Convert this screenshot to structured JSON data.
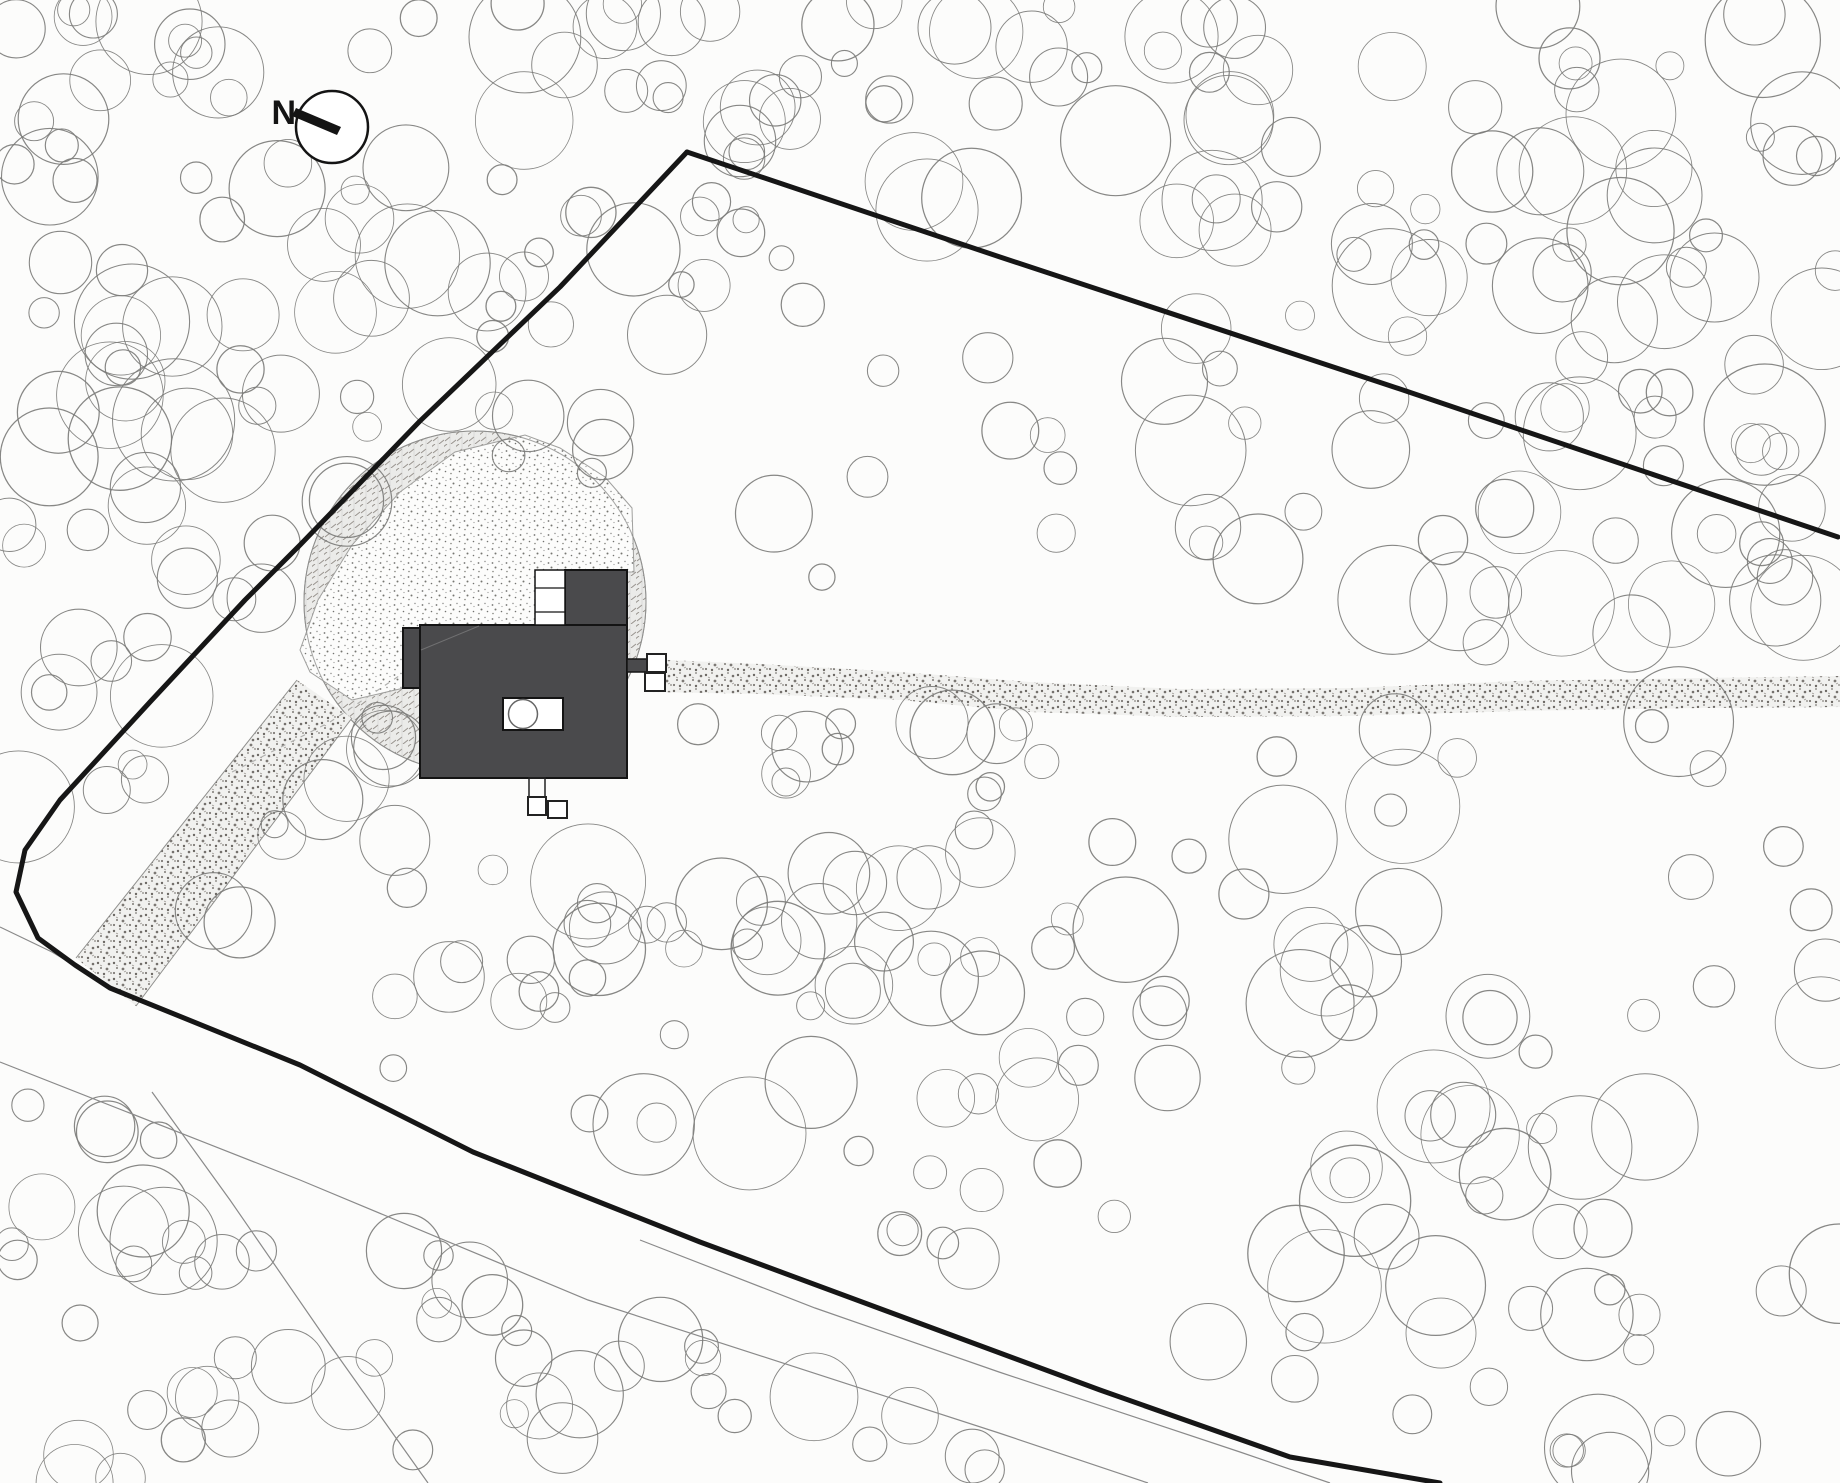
{
  "title": "Architectural site plan",
  "compass": {
    "label": "N",
    "cx": 332,
    "cy": 127,
    "r": 36,
    "needle": [
      [
        292,
        116
      ],
      [
        296,
        108
      ],
      [
        341,
        127
      ],
      [
        337,
        135
      ]
    ],
    "label_x": 296,
    "label_y": 124
  },
  "colors": {
    "background": "#fcfcfb",
    "boundary": "#161616",
    "thin_line": "#8a8a8a",
    "tree_stroke": "#7a7a78",
    "building_fill": "#4a4a4c",
    "building_outline": "#141414",
    "hatch_outline": "#8f8f8d",
    "stipple_edge": "#a0a09e",
    "contour_dash": "#b0b0ae",
    "white": "#ffffff"
  },
  "site": {
    "clearing": {
      "cx": 475,
      "cy": 602,
      "r": 171
    },
    "stipple_area": [
      [
        300,
        650
      ],
      [
        318,
        600
      ],
      [
        352,
        545
      ],
      [
        400,
        492
      ],
      [
        455,
        452
      ],
      [
        525,
        435
      ],
      [
        560,
        448
      ],
      [
        605,
        477
      ],
      [
        632,
        508
      ],
      [
        634,
        572
      ],
      [
        565,
        572
      ],
      [
        565,
        625
      ],
      [
        420,
        627
      ],
      [
        404,
        688
      ],
      [
        352,
        700
      ],
      [
        310,
        672
      ]
    ],
    "corridor": {
      "poly": [
        [
          297,
          680
        ],
        [
          352,
          718
        ],
        [
          136,
          1006
        ],
        [
          76,
          958
        ]
      ],
      "edge1": [
        [
          297,
          680
        ],
        [
          76,
          958
        ]
      ],
      "edge2": [
        [
          352,
          718
        ],
        [
          136,
          1006
        ]
      ]
    },
    "access_path": [
      [
        642,
        659
      ],
      [
        760,
        664
      ],
      [
        900,
        672
      ],
      [
        1030,
        682
      ],
      [
        1180,
        689
      ],
      [
        1350,
        688
      ],
      [
        1520,
        681
      ],
      [
        1700,
        678
      ],
      [
        1840,
        676
      ],
      [
        1840,
        707
      ],
      [
        1700,
        708
      ],
      [
        1520,
        711
      ],
      [
        1350,
        716
      ],
      [
        1180,
        717
      ],
      [
        1030,
        712
      ],
      [
        900,
        700
      ],
      [
        760,
        694
      ],
      [
        652,
        692
      ]
    ],
    "contour_dashed": [
      [
        232,
        772
      ],
      [
        330,
        722
      ],
      [
        420,
        662
      ]
    ],
    "boundary_left_bottom": [
      [
        687,
        152
      ],
      [
        560,
        287
      ],
      [
        420,
        421
      ],
      [
        300,
        545
      ],
      [
        245,
        600
      ],
      [
        150,
        702
      ],
      [
        60,
        800
      ],
      [
        25,
        850
      ],
      [
        16,
        892
      ],
      [
        38,
        938
      ],
      [
        75,
        965
      ],
      [
        110,
        988
      ],
      [
        300,
        1065
      ],
      [
        473,
        1152
      ],
      [
        700,
        1242
      ],
      [
        954,
        1336
      ],
      [
        1100,
        1390
      ],
      [
        1290,
        1457
      ],
      [
        1440,
        1483
      ]
    ],
    "boundary_top_right": [
      [
        687,
        152
      ],
      [
        1000,
        257
      ],
      [
        1400,
        389
      ],
      [
        1838,
        537
      ]
    ],
    "roads": [
      {
        "pts": [
          [
            0,
            927
          ],
          [
            52,
            952
          ],
          [
            92,
            976
          ]
        ]
      },
      {
        "pts": [
          [
            0,
            1062
          ],
          [
            300,
            1180
          ],
          [
            588,
            1300
          ],
          [
            999,
            1433
          ],
          [
            1148,
            1483
          ]
        ]
      },
      {
        "pts": [
          [
            640,
            1240
          ],
          [
            815,
            1308
          ],
          [
            999,
            1372
          ],
          [
            1240,
            1452
          ],
          [
            1330,
            1483
          ]
        ]
      },
      {
        "pts": [
          [
            152,
            1092
          ],
          [
            230,
            1200
          ],
          [
            330,
            1345
          ],
          [
            428,
            1483
          ]
        ]
      }
    ],
    "building": {
      "main": {
        "x": 420,
        "y": 625,
        "w": 207,
        "h": 153
      },
      "ext": {
        "x": 403,
        "y": 628,
        "w": 17,
        "h": 60
      },
      "annex": {
        "x": 565,
        "y": 570,
        "w": 62,
        "h": 55
      },
      "stairs": {
        "x": 535,
        "y": 570,
        "w": 30,
        "h": 55,
        "rungs": [
          588,
          612
        ]
      },
      "patio": {
        "x": 503,
        "y": 698,
        "w": 60,
        "h": 32,
        "circle": {
          "cx": 523,
          "cy": 714,
          "r": 14.5
        }
      },
      "roof_line": [
        [
          421,
          650
        ],
        [
          479,
          626
        ]
      ],
      "right_stub": {
        "x": 627,
        "y": 659,
        "w": 20,
        "h": 13
      },
      "right_boxes": [
        {
          "x": 647,
          "y": 654,
          "w": 19,
          "h": 18
        },
        {
          "x": 645,
          "y": 673,
          "w": 20,
          "h": 18
        }
      ],
      "bottom_stub": {
        "x": 529,
        "y": 778,
        "w": 16,
        "h": 20
      },
      "bottom_boxes": [
        {
          "x": 528,
          "y": 797,
          "w": 18,
          "h": 18
        },
        {
          "x": 548,
          "y": 801,
          "w": 19,
          "h": 17
        }
      ]
    }
  },
  "trees": {
    "seed": 1337,
    "regions": [
      {
        "x": 0,
        "y": 0,
        "w": 270,
        "h": 930,
        "count": 60,
        "rmin": 14,
        "rmax": 62
      },
      {
        "x": 0,
        "y": 1060,
        "w": 300,
        "h": 423,
        "count": 26,
        "rmin": 16,
        "rmax": 55
      },
      {
        "x": 270,
        "y": 0,
        "w": 420,
        "h": 270,
        "count": 26,
        "rmin": 14,
        "rmax": 58
      },
      {
        "x": 690,
        "y": 0,
        "w": 560,
        "h": 240,
        "count": 40,
        "rmin": 13,
        "rmax": 55
      },
      {
        "x": 1250,
        "y": 0,
        "w": 590,
        "h": 320,
        "count": 42,
        "rmin": 14,
        "rmax": 60
      },
      {
        "x": 1150,
        "y": 320,
        "w": 690,
        "h": 700,
        "count": 72,
        "rmin": 16,
        "rmax": 62
      },
      {
        "x": 1150,
        "y": 1020,
        "w": 690,
        "h": 463,
        "count": 40,
        "rmin": 15,
        "rmax": 58
      },
      {
        "x": 550,
        "y": 690,
        "w": 620,
        "h": 580,
        "count": 66,
        "rmin": 14,
        "rmax": 60
      },
      {
        "x": 270,
        "y": 270,
        "w": 340,
        "h": 420,
        "count": 20,
        "rmin": 13,
        "rmax": 48
      },
      {
        "x": 610,
        "y": 240,
        "w": 540,
        "h": 440,
        "count": 14,
        "rmin": 12,
        "rmax": 40
      },
      {
        "x": 300,
        "y": 1230,
        "w": 820,
        "h": 253,
        "count": 30,
        "rmin": 14,
        "rmax": 52
      },
      {
        "x": 270,
        "y": 690,
        "w": 300,
        "h": 540,
        "count": 18,
        "rmin": 13,
        "rmax": 45
      }
    ],
    "masks": {
      "clearing_r": 150,
      "compass_r": 52,
      "building": [
        395,
        560,
        675,
        830
      ],
      "path": {
        "x_min": 620,
        "y_min": 650,
        "y_max": 718
      },
      "road_top": [
        [
          0,
          925
        ],
        [
          110,
          988
        ],
        [
          300,
          1065
        ],
        [
          473,
          1152
        ],
        [
          700,
          1242
        ],
        [
          954,
          1336
        ],
        [
          1100,
          1390
        ],
        [
          1290,
          1457
        ],
        [
          1440,
          1483
        ]
      ],
      "road_bottom": [
        [
          0,
          1062
        ],
        [
          300,
          1180
        ],
        [
          588,
          1300
        ],
        [
          999,
          1433
        ],
        [
          1148,
          1483
        ]
      ],
      "road_margin_top": 28,
      "road_margin_bottom": 6,
      "corridor_seg": [
        [
          300,
          690
        ],
        [
          90,
          985
        ]
      ],
      "corridor_r": 55
    }
  }
}
